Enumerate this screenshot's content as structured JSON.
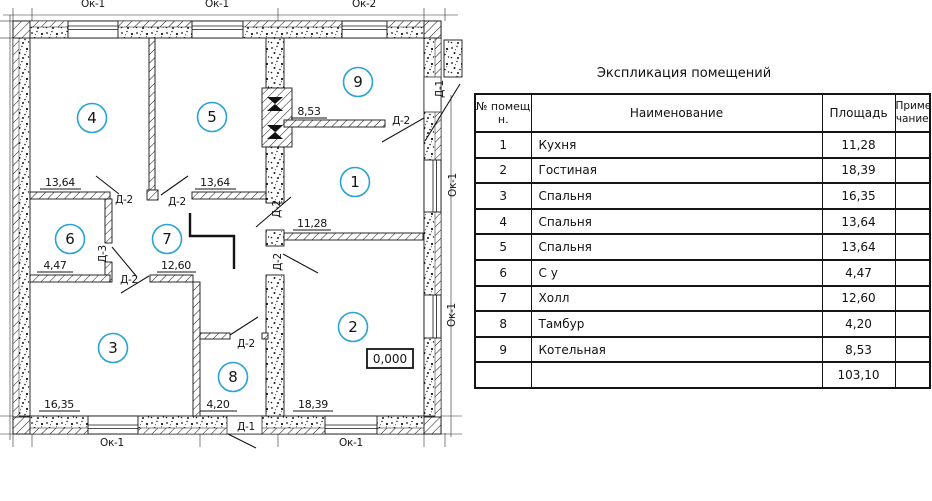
{
  "plan": {
    "accent": "#2ba3d4",
    "room_numbers": {
      "r1": "1",
      "r2": "2",
      "r3": "3",
      "r4": "4",
      "r5": "5",
      "r6": "6",
      "r7": "7",
      "r8": "8",
      "r9": "9"
    },
    "dims": {
      "r1": "11,28",
      "r2": "18,39",
      "r3": "16,35",
      "r4": "13,64",
      "r5": "13,64",
      "r6": "4,47",
      "r7": "12,60",
      "r8": "4,20",
      "r9": "8,53"
    },
    "elevation": "0,000",
    "door_labels": {
      "d1": "Д-1",
      "d2": "Д-2",
      "d3": "Д-3"
    },
    "window_labels": {
      "ok1": "Ок-1",
      "ok2": "Ок-2"
    }
  },
  "table": {
    "title": "Экспликация помещений",
    "columns": {
      "num_l1": "№ помеще",
      "num_l2": "н.",
      "name": "Наименование",
      "area": "Площадь",
      "note_l1": "Приме",
      "note_l2": "чание"
    },
    "rows": [
      {
        "num": "1",
        "name": "Кухня",
        "area": "11,28",
        "note": ""
      },
      {
        "num": "2",
        "name": "Гостиная",
        "area": "18,39",
        "note": ""
      },
      {
        "num": "3",
        "name": "Спальня",
        "area": "16,35",
        "note": ""
      },
      {
        "num": "4",
        "name": "Спальня",
        "area": "13,64",
        "note": ""
      },
      {
        "num": "5",
        "name": "Спальня",
        "area": "13,64",
        "note": ""
      },
      {
        "num": "6",
        "name": "С у",
        "area": "4,47",
        "note": ""
      },
      {
        "num": "7",
        "name": "Холл",
        "area": "12,60",
        "note": ""
      },
      {
        "num": "8",
        "name": "Тамбур",
        "area": "4,20",
        "note": ""
      },
      {
        "num": "9",
        "name": "Котельная",
        "area": "8,53",
        "note": ""
      }
    ],
    "total": {
      "num": "",
      "name": "",
      "area": "103,10",
      "note": ""
    }
  }
}
